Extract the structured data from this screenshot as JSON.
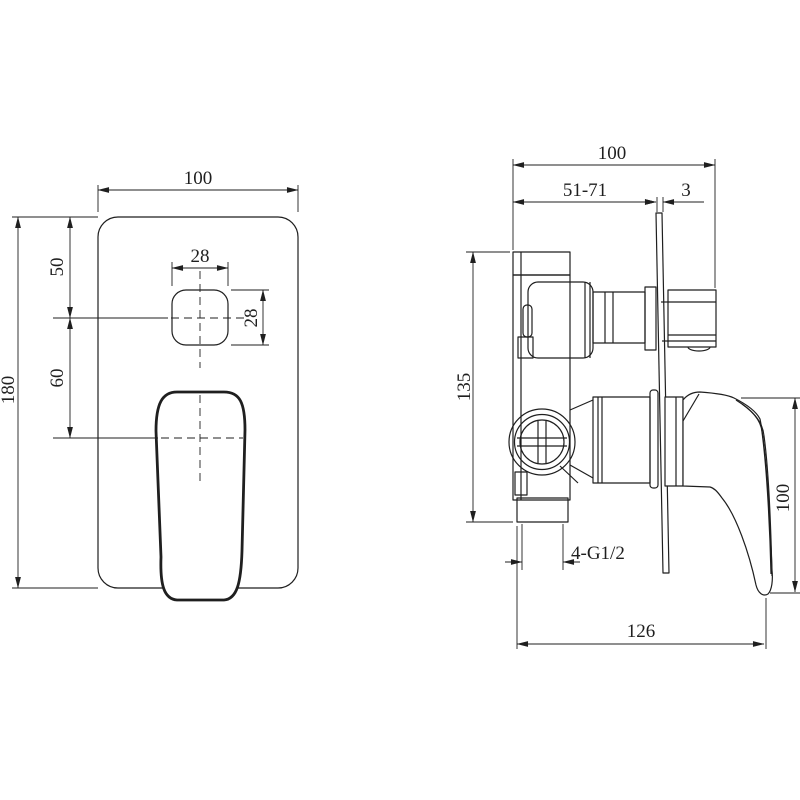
{
  "colors": {
    "line": "#1f1f1f",
    "background": "#ffffff"
  },
  "front_view": {
    "plate_width": "100",
    "hole_width": "28",
    "hole_height": "28",
    "top_to_hole_center": "50",
    "hole_to_handle_center": "60",
    "plate_height": "180"
  },
  "side_view": {
    "overall_width": "100",
    "mounting_depth_range": "51-71",
    "plate_thickness": "3",
    "body_height": "135",
    "handle_height": "100",
    "thread_spec": "4-G1/2",
    "overall_depth": "126"
  }
}
